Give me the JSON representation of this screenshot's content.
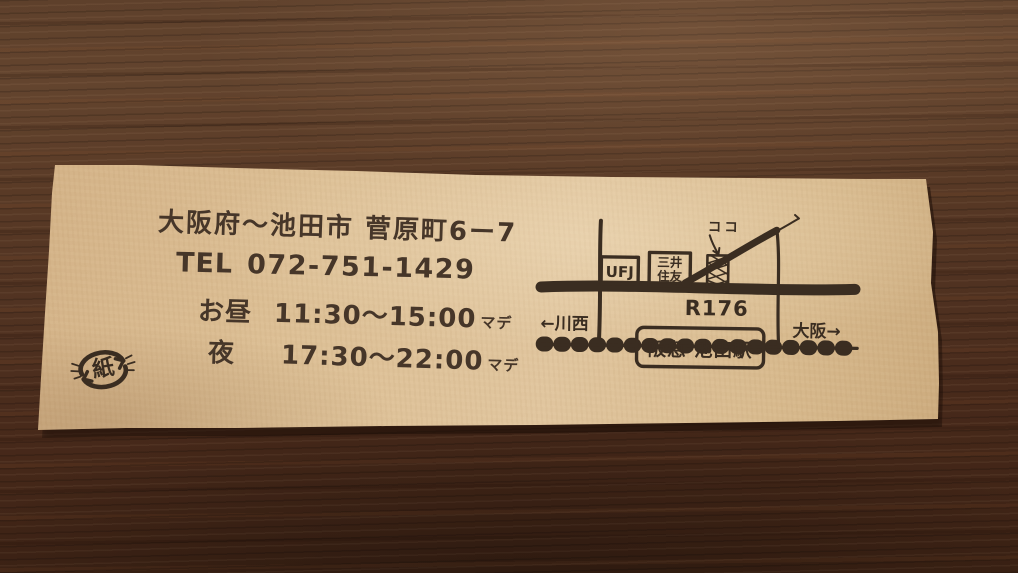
{
  "note": {
    "address": "大阪府〜池田市 菅原町6ー7",
    "tel": {
      "label": "TEL",
      "number": "072-751-1429"
    },
    "hours": {
      "lunch": {
        "label": "お昼",
        "time": "11:30〜15:00",
        "suffix": "マデ"
      },
      "dinner": {
        "label": "夜",
        "time": "17:30〜22:00",
        "suffix": "マデ"
      }
    },
    "recycle_stamp": {
      "kanji": "紙"
    },
    "map": {
      "here": "ココ",
      "bank_ufj": "UFJ",
      "bank_mitsui": {
        "line1": "三井",
        "line2": "住友"
      },
      "route": "R176",
      "west": "←川西",
      "east": "大阪→",
      "station": "阪急 池田駅"
    }
  },
  "colors": {
    "ink": "#3a2d21",
    "paper": "#dcbf95",
    "wood": "#503221"
  }
}
